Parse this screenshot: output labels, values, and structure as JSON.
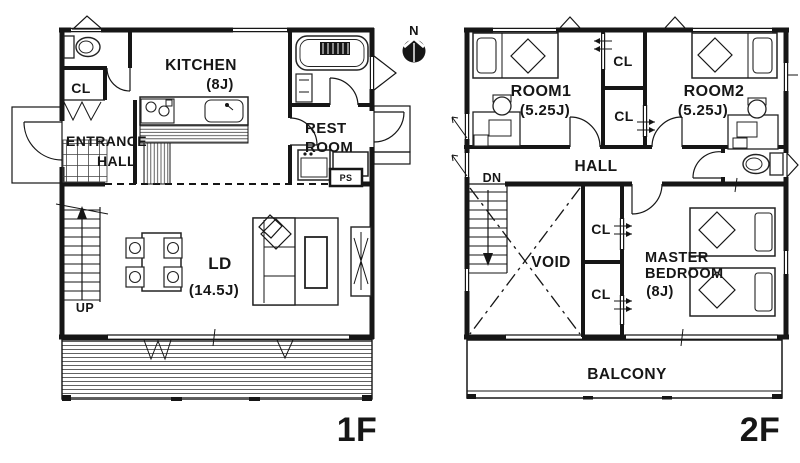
{
  "compass": {
    "north": "N"
  },
  "floor1": {
    "floor_label": "1F",
    "labels": {
      "cl": "CL",
      "entrance_line1": "ENTRANCE",
      "entrance_line2": "HALL",
      "kitchen": "KITCHEN",
      "kitchen_size": "(8J)",
      "rest_line1": "REST",
      "rest_line2": "ROOM",
      "ps": "PS",
      "ld": "LD",
      "ld_size": "(14.5J)",
      "stairs": "UP"
    }
  },
  "floor2": {
    "floor_label": "2F",
    "labels": {
      "room1": "ROOM1",
      "room1_size": "(5.25J)",
      "room2": "ROOM2",
      "room2_size": "(5.25J)",
      "cl_upper": "CL",
      "cl_lower": "CL",
      "hall": "HALL",
      "stairs": "DN",
      "void": "VOID",
      "cl_master_upper": "CL",
      "cl_master_lower": "CL",
      "master_line1": "MASTER",
      "master_line2": "BEDROOM",
      "master_size": "(8J)",
      "balcony": "BALCONY"
    }
  },
  "colors": {
    "ink": "#161616",
    "paper": "#ffffff"
  }
}
